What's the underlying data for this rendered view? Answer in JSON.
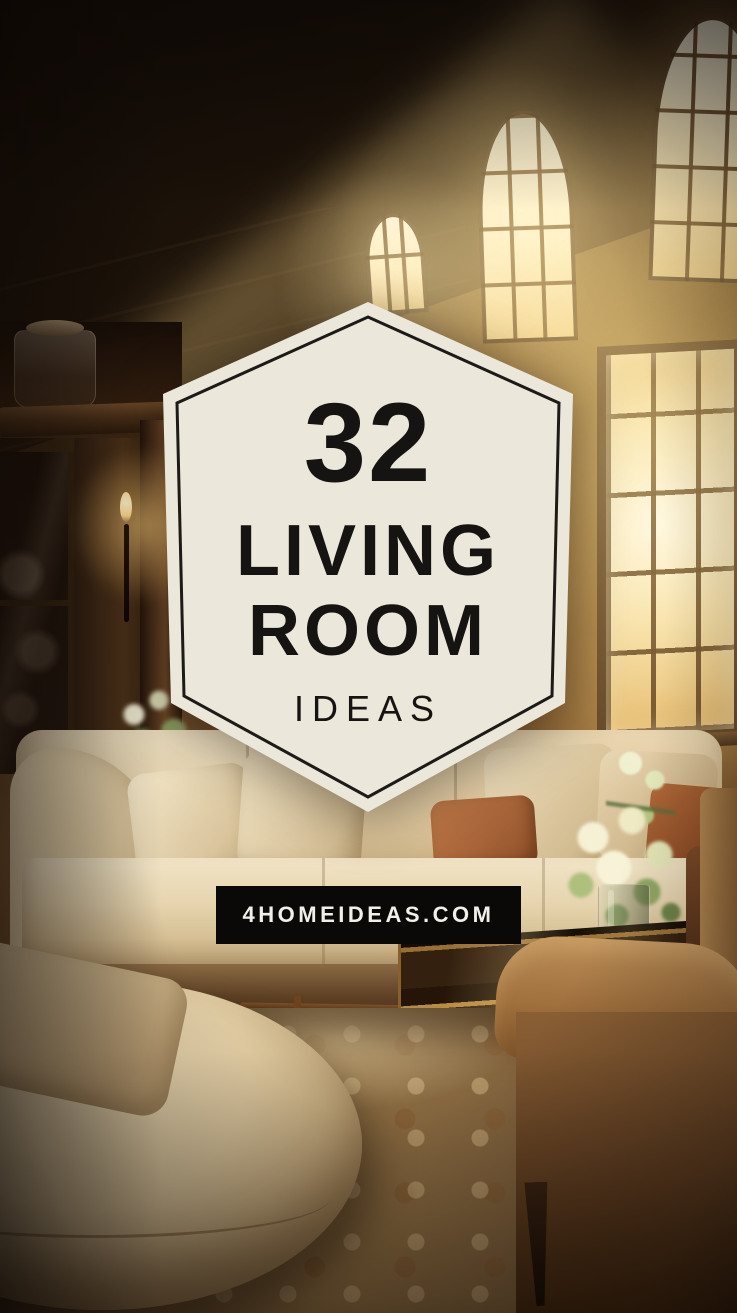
{
  "badge": {
    "count": "32",
    "title_line1": "LIVING",
    "title_line2": "ROOM",
    "subtitle": "IDEAS"
  },
  "banner": {
    "text": "4HOMEIDEAS.COM"
  },
  "colors": {
    "badge-bg": "#ece7db",
    "badge-border": "#1d1b18",
    "badge-text": "#161412",
    "banner-bg": "#0b0908",
    "banner-text": "#f2efe9",
    "glow-gold": "#f5c97d",
    "sofa-cream": "#e6d3ac",
    "wood-dark": "#2a1a0e",
    "armchair-camel": "#a5794a",
    "rug-tan": "#8a6a42"
  }
}
